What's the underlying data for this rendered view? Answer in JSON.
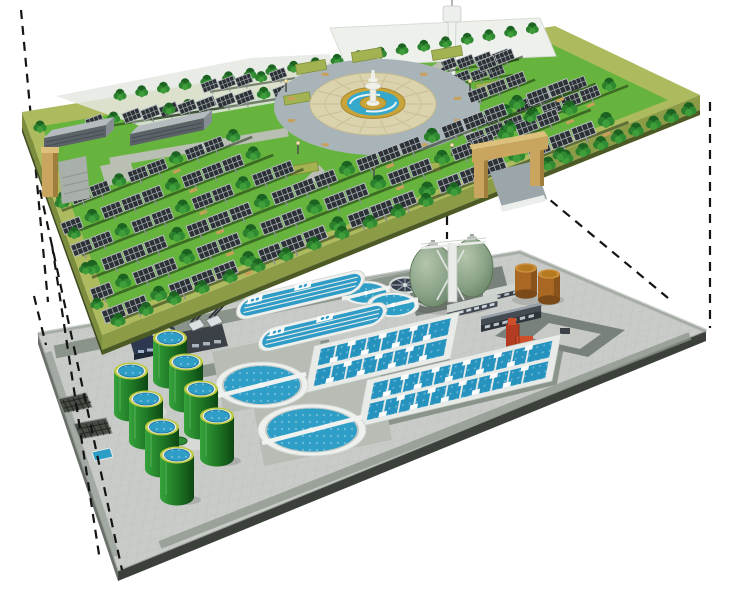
{
  "scene": {
    "type": "cutaway-axonometric-illustration",
    "subject": "underground-wastewater-treatment-plant-beneath-solar-park",
    "layers": [
      "solar-park-surface",
      "underground-treatment-plant"
    ],
    "background": "#ffffff"
  },
  "palette": {
    "grass": "#66b43d",
    "park_rim": "#aeba5e",
    "park_side_front": "#8b9b46",
    "park_side_left": "#7d8d3e",
    "park_lip": "#4c5a26",
    "panel_dark": "#2c3136",
    "panel_grid": "#aab0b5",
    "panel_post": "#8a8f94",
    "tree_dark": "#1c6322",
    "tree_mid": "#2b7f2d",
    "tree_mid2": "#2f8a31",
    "tree_light": "#3f9d3a",
    "trunk": "#7a5230",
    "plaza_ring": "#a9b4b8",
    "plaza_pave": "#dbd3ae",
    "plaza_pave_line": "#c6bc8e",
    "fountain_gold": "#c9a43a",
    "fountain_blue": "#35a9cb",
    "building_front": "#5b6268",
    "building_roof": "#b6bbc0",
    "tower_white": "#f0f2ee",
    "gate_tan": "#c9a55f",
    "gate_tan_shade": "#a07f3d",
    "gate_tan_top": "#ddc07c",
    "platform_top": "#c8cbc7",
    "platform_side": "#3b403b",
    "road_sage": "#79827a",
    "road_sage_light": "#8b948b",
    "apron": "#b7bdb5",
    "water": "#2f9ec6",
    "water_deep": "#2693bf",
    "rim_white": "#eef0ee",
    "clarifier_wall": "#c3c9c5",
    "tank_green_light": "#36a33c",
    "tank_green_dark": "#0d4713",
    "tank_rim_yellow": "#bcca40",
    "egg_green_light": "#b4c6ad",
    "egg_green_dark": "#5f7a5e",
    "brown_tank": "#a86722",
    "brown_tank_top": "#c98f3c",
    "red_equipment": "#cf4f2d",
    "red_equipment_dark": "#b23c22",
    "navy_building": "#2c3950",
    "dark_building": "#3b4147",
    "light_building": "#cdd2cd",
    "window_light": "#b9c3cc",
    "bench_tan": "#c8a05a",
    "dash_line": "#141414"
  },
  "inventory": {
    "park": {
      "solar_panels_approx": 110,
      "trees_approx": 85,
      "service_buildings": 2,
      "observation_tower": 1,
      "central_fountain_plaza": 1,
      "planter_hedges": 7,
      "entrance_gate_arch": 1,
      "entrance_pillar": 1
    },
    "plant": {
      "egg_shaped_digesters": 2,
      "brown_sludge_tanks": 2,
      "oxidation_ditches": 2,
      "circular_clarifiers_large": 2,
      "circular_clarifiers_medium": 2,
      "covered_thickeners_small": 2,
      "aeration_basin_groups": 2,
      "green_storage_tanks": 8,
      "screen_units": 2,
      "covered_tank_building": 1,
      "service_buildings": 3,
      "red_pump_unit": 1,
      "inlet_grates": 2
    },
    "connectors": {
      "dashed_projection_lines": 7
    }
  }
}
